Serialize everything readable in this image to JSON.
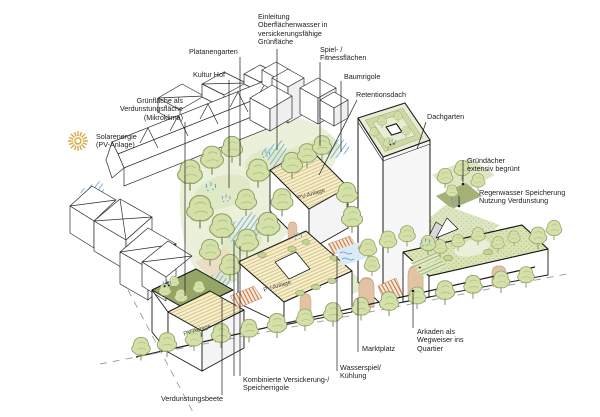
{
  "diagram": {
    "type": "axonometric-site-illustration",
    "palette": {
      "background": "#ffffff",
      "line": "#1a1a1a",
      "tree_green": "#d3e0a8",
      "tree_outline": "#8fa065",
      "park_green": "#eaf0da",
      "park_green_mid": "#dfe9c6",
      "roof_green_dark": "#93a465",
      "roof_green_light": "#d9e3b4",
      "pv_roof": "#f6efcf",
      "pv_stripe": "#d6c483",
      "water_blue": "#6fa8d6",
      "arch_tan": "#e2c3a6",
      "step_orange": "#c8763e",
      "sun_gold": "#d9a53f"
    }
  },
  "annotations": {
    "einleitung": "Einleitung\nOberflächenwasser in\nversickerungsfähige\nGrünfläche",
    "platanengarten": "Platanengarten",
    "kultur_hof": "Kultur Hof",
    "gruenflaeche": "Grünfläche als\nVerdunstungsfläche\n(Mikroklima)",
    "solarenergie": "Solarenergie\n(PV-Anlage)",
    "spiel_fitness": "Spiel- /\nFitnessflächen",
    "baumrigole": "Baumrigole",
    "retentionsdach": "Retentionsdach",
    "dachgarten": "Dachgarten",
    "gruendaecher": "Gründächer\nextensiv begrünt",
    "regenwasser": "Regenwasser Speicherung\nNutzung Verdunstung",
    "arkaden": "Arkaden als\nWegweiser ins\nQuartier",
    "marktplatz": "Marktplatz",
    "wasserspiel": "Wasserspiel/\nKühlung",
    "versickerung": "Kombinierte Versickerung-/\nSpeicherrigole",
    "verdunstungsbeete": "Verdunstungsbeete",
    "pv_roof": "PV-Anlage"
  }
}
